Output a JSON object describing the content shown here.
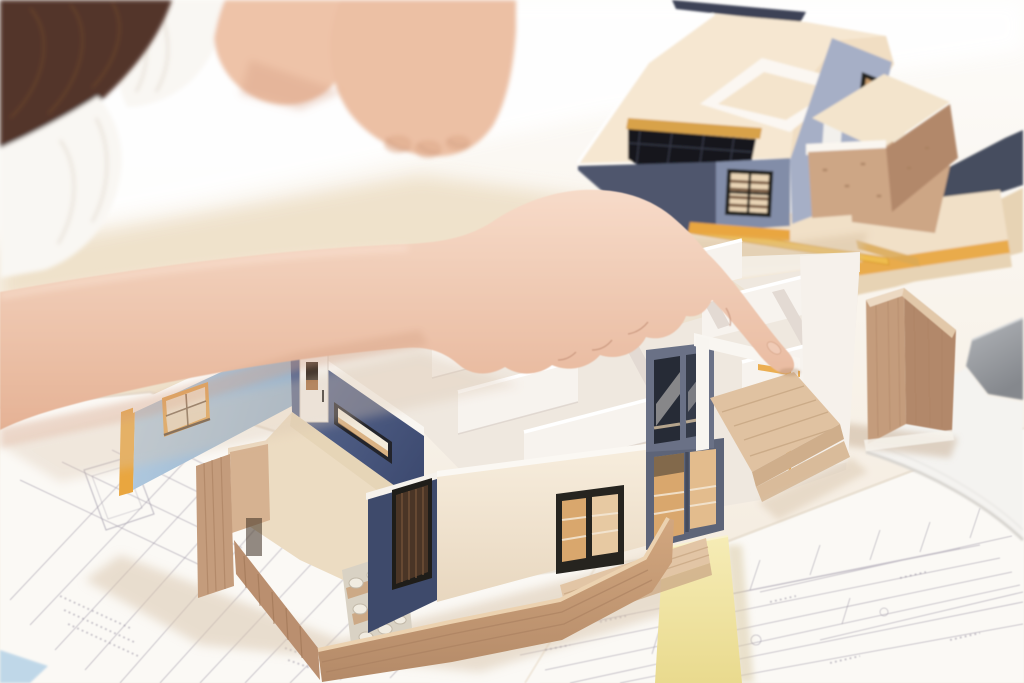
{
  "scene": {
    "type": "photograph",
    "subject": "two-people-reviewing-architectural-house-models-and-blueprints",
    "objects": [
      "woman-hair",
      "woman-shirt",
      "woman-arm",
      "pointing-hand",
      "index-finger",
      "partner-arms",
      "partner-fist",
      "shirt-sleeve",
      "main-house-model",
      "exterior-wall-light-blue",
      "interior-navy-wall",
      "entry-door",
      "ribbon-window",
      "interior-partition-walls",
      "room-floor",
      "wood-plank-wall",
      "stone-path",
      "front-cream-wall",
      "front-window",
      "louver-window",
      "sliding-glass-door",
      "terrace-frame",
      "wood-deck",
      "front-plank-fence",
      "roof-model",
      "roof-deck",
      "roof-skylight",
      "roof-parapet",
      "roof-gable-window",
      "roof-balcony",
      "stacked-boards",
      "pencil",
      "wood-corner-piece",
      "laptop",
      "sticky-note",
      "blueprint-sheet-left",
      "blueprint-sheet-right",
      "table"
    ],
    "palette": {
      "white": "#ffffff",
      "paper": "#fbf9f5",
      "blueprint_line": "#9e97a8",
      "hair": "#53362a",
      "skin": "#f0cbb5",
      "skin_shadow": "#d7a68a",
      "shirt": "#f9f7f3",
      "board_cream": "#f1e0c7",
      "board_cream2": "#e7d3b4",
      "orange": "#e9a63f",
      "navy_board": "#3d4357",
      "roof_top": "#f6e7d1",
      "slate_light": "#a6afc6",
      "slate_mid": "#828da8",
      "slate_dark": "#4f576d",
      "model_navy": "#4d5e85",
      "model_navy_dark": "#3e4a6b",
      "blue_wall": "#a9c4db",
      "white_wall": "#f8f4ef",
      "wall_shade": "#e3dad3",
      "floor": "#ecdcc2",
      "plywood": "#cda685",
      "plywood_dark": "#b2886a",
      "plywood_light": "#e2c5a5",
      "deck_wood": "#c89b72",
      "window_orange": "#e1a04c",
      "window_black": "#26241f",
      "glass_warm": "#d9a76d",
      "stone": "#d9d2c4",
      "sticky": "#f1e5a4",
      "laptop_gray": "#95989d",
      "shadow": "#d7c2a9"
    }
  }
}
